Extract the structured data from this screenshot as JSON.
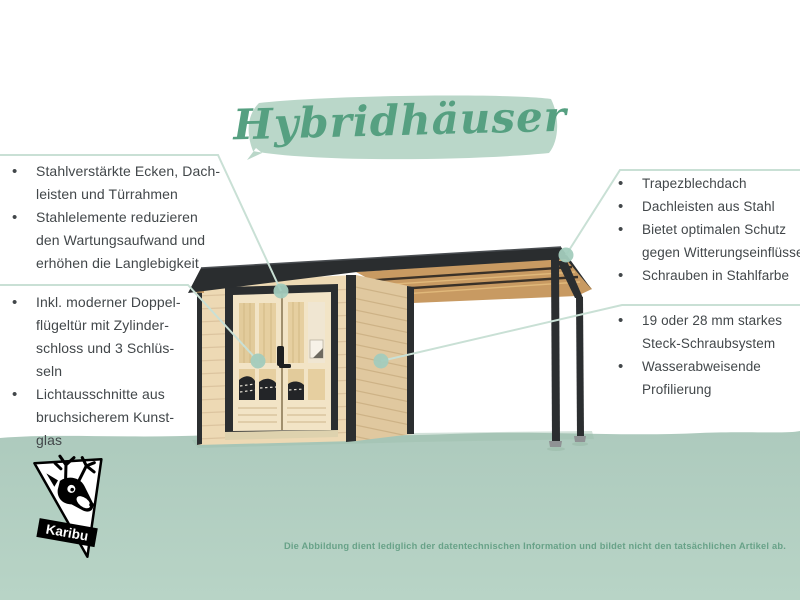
{
  "title": "Hybridhäuser",
  "features": {
    "left_top": [
      "Stahlverstärkte Ecken, Dach-\nleisten und Türrahmen",
      "Stahlelemente reduzieren\nden Wartungsaufwand und\nerhöhen die Langlebigkeit"
    ],
    "left_bottom": [
      "Inkl. moderner Doppel-\nflügeltür mit Zylinder-\nschloss und 3 Schlüs-\nseln",
      "Lichtausschnitte aus\nbruchsicherem Kunst-\nglas"
    ],
    "right_top": [
      "Trapezblechdach",
      "Dachleisten aus Stahl",
      "Bietet optimalen Schutz\ngegen Witterungseinflüsse",
      "Schrauben in Stahlfarbe"
    ],
    "right_bottom": [
      "19 oder 28 mm starkes\nSteck-Schraubsystem",
      "Wasserabweisende\nProfilierung"
    ]
  },
  "logo": {
    "label": "Karibu",
    "icon": "deer-logo"
  },
  "footer": {
    "disclaimer": "Die Abbildung dient lediglich der datentechnischen Information und bildet nicht den tatsächlichen Artikel ab."
  },
  "colors": {
    "title_green": "#56a081",
    "brush_mint": "#bad7c9",
    "ground_mint": "#b5d1c4",
    "callout_line": "#c9e0d5",
    "callout_dot": "#a3ccbd",
    "body_text": "#42474a",
    "roof_dark": "#2a2d2f",
    "wood_front": "#edd9b4",
    "wood_side": "#e0c89f",
    "door_cream": "#f2e4c6",
    "disclaimer_green": "#68a288"
  }
}
